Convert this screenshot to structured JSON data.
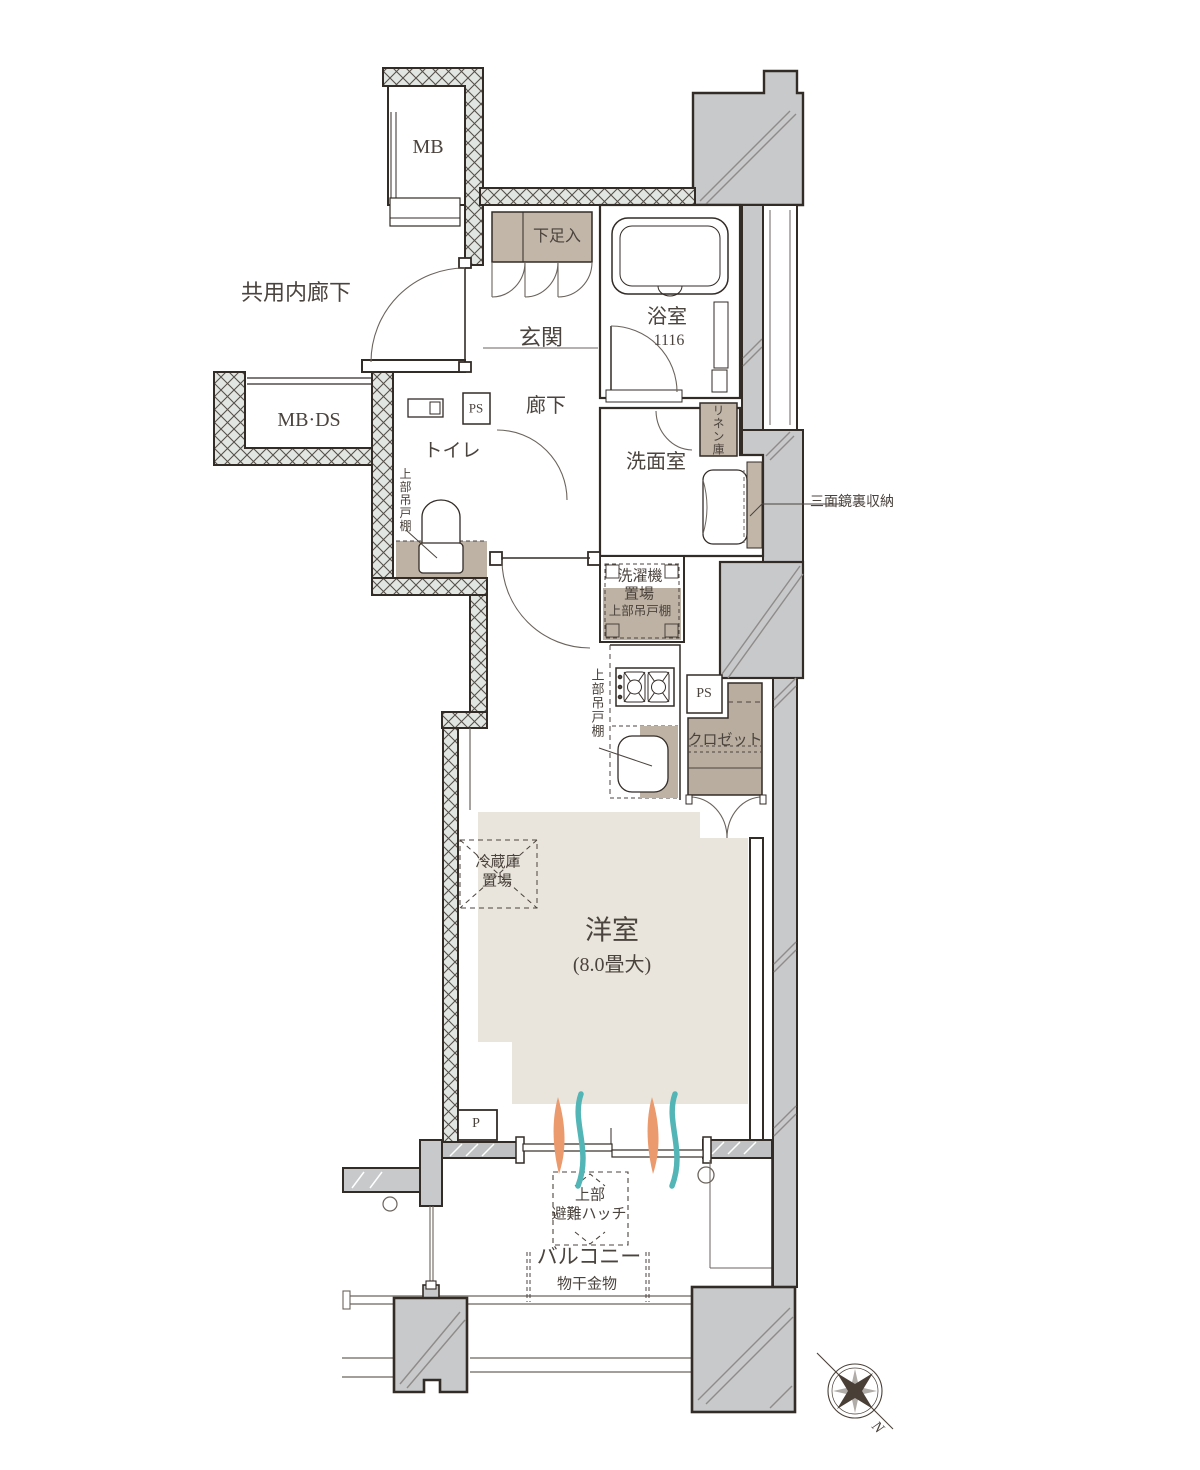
{
  "plan_type": "apartment-floor-plan",
  "labels": {
    "shared_corridor": "共用内廊下",
    "mb": "MB",
    "mb_ds": "MB·DS",
    "shoe_cabinet": "下足入",
    "entrance": "玄関",
    "bathroom": "浴室",
    "bathroom_size": "1116",
    "hallway": "廊下",
    "ps_upper": "PS",
    "toilet": "トイレ",
    "toilet_upper_cabinet": "上部吊戸棚",
    "washroom": "洗面室",
    "linen_closet": "リネン庫",
    "mirror_storage": "三面鏡裏収納",
    "washer_line1": "洗濯機",
    "washer_line2": "置場",
    "washer_line3": "上部吊戸棚",
    "kitchen_upper_cabinet": "上部吊戸棚",
    "ps_lower": "PS",
    "closet": "クロゼット",
    "fridge_line1": "冷蔵庫",
    "fridge_line2": "置場",
    "western_room": "洋室",
    "western_room_size": "(8.0畳大)",
    "pipe_p": "P",
    "hatch_line1": "上部",
    "hatch_line2": "避難ハッチ",
    "balcony": "バルコニー",
    "drying_hardware": "物干金物",
    "compass_north": "N"
  },
  "colors": {
    "wall_outline": "#332b26",
    "hatch_wall_fill": "#e2e6e2",
    "concrete_gray": "#c7c9cb",
    "fixture_tan": "#c1b6a8",
    "closet_tan": "#b8ad9e",
    "room_floor_beige": "#e9e5dd",
    "text": "#4b433d",
    "flame_orange": "#ea9a6d",
    "wave_teal": "#54b5b6"
  }
}
